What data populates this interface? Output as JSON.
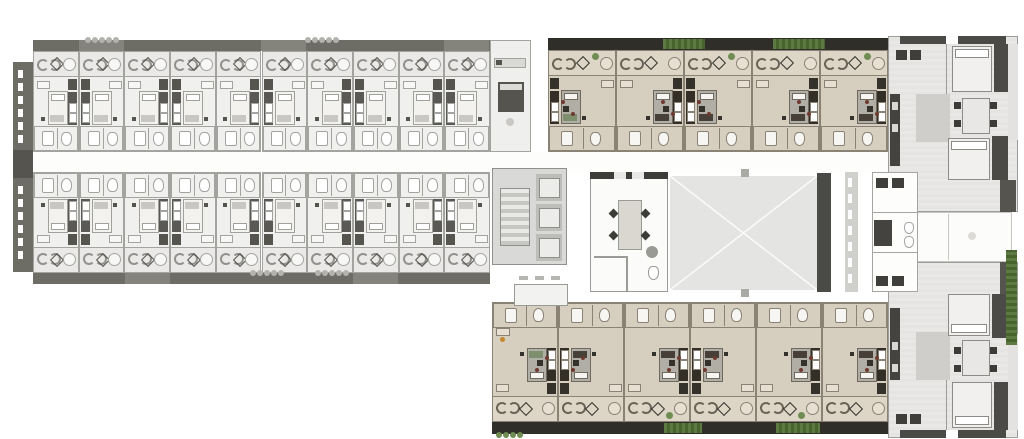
{
  "plan": {
    "building_label": "residential-floor-plan",
    "west_wing": {
      "label": "west guestroom wing",
      "palette": "gray",
      "north_rooms": 10,
      "south_rooms": 10
    },
    "center": {
      "label": "center suite section",
      "palette": "tan",
      "north_suites": 5,
      "south_suites": 6,
      "elevator_count": 3,
      "features": [
        "stairwell",
        "elevator-bank",
        "lounge",
        "courtyard",
        "planter",
        "bathroom-core",
        "corridor"
      ]
    },
    "east_wing": {
      "label": "east apartment wing",
      "palette": "gray",
      "apartments": 2
    }
  },
  "colors": {
    "background": "#ffffff",
    "gray_floor": "#f0f0ef",
    "gray_balcony": "#eae9e8",
    "gray_wall": "#a3a3a0",
    "gray_dark": "#55544f",
    "parapet_gray": "#6d6d66",
    "plant_gray": "#b3b3ad",
    "corridor": "#fdfdfc",
    "tan_floor": "#d6cfc0",
    "tan_balcony": "#ddd6c7",
    "tan_wall": "#8a8274",
    "tan_dark": "#35322b",
    "tan_parapet": "#302e29",
    "wood": "#4f4437",
    "hedge_green": "#5d7a43",
    "hedge_green_dark": "#49632f",
    "plant_green": "#6f8c52",
    "bed_white": "#f3f2ef",
    "bed_gray": "#b1aea6",
    "accent_red": "#6e3a30",
    "accent_orange": "#c8862e",
    "courtyard_fill": "#e4e4e2",
    "core_fill": "#d9d9d7",
    "east_floor_a": "#e9e8e6",
    "east_floor_b": "#e5e4e2",
    "east_rug": "#cfcecb",
    "white_room": "#fbfbfa"
  }
}
